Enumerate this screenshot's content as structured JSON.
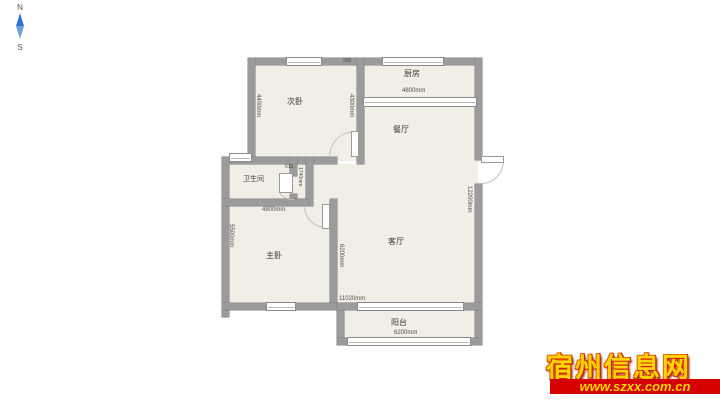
{
  "compass": {
    "north_label": "N",
    "south_label": "S",
    "needle_color": "#2f72d2"
  },
  "floorplan": {
    "colors": {
      "wall": "#9b9b9b",
      "floor": "#f1eee6"
    },
    "rooms": {
      "secondary_bedroom": {
        "label": "次卧",
        "dim_left": "4400mm",
        "dim_right": "4300mm",
        "dim_top": "900"
      },
      "kitchen": {
        "label": "厨房",
        "dim_width": "4800mm"
      },
      "dining": {
        "label": "餐厅"
      },
      "bathroom": {
        "label": "卫生间",
        "dim_niche": "610",
        "dim_hall": "1740mm"
      },
      "master_bedroom": {
        "label": "主卧",
        "dim_width": "4800mm",
        "dim_height": "5500mm"
      },
      "living": {
        "label": "客厅",
        "dim_left": "6200mm",
        "dim_right": "12200mm",
        "dim_bottom": "11020mm"
      },
      "balcony": {
        "label": "阳台",
        "dim_width": "6200mm"
      }
    }
  },
  "watermark": {
    "site_name": "宿州信息网",
    "site_url": "www.szxx.com.cn",
    "banner_color": "#d60000",
    "text_color": "#ffd400"
  }
}
